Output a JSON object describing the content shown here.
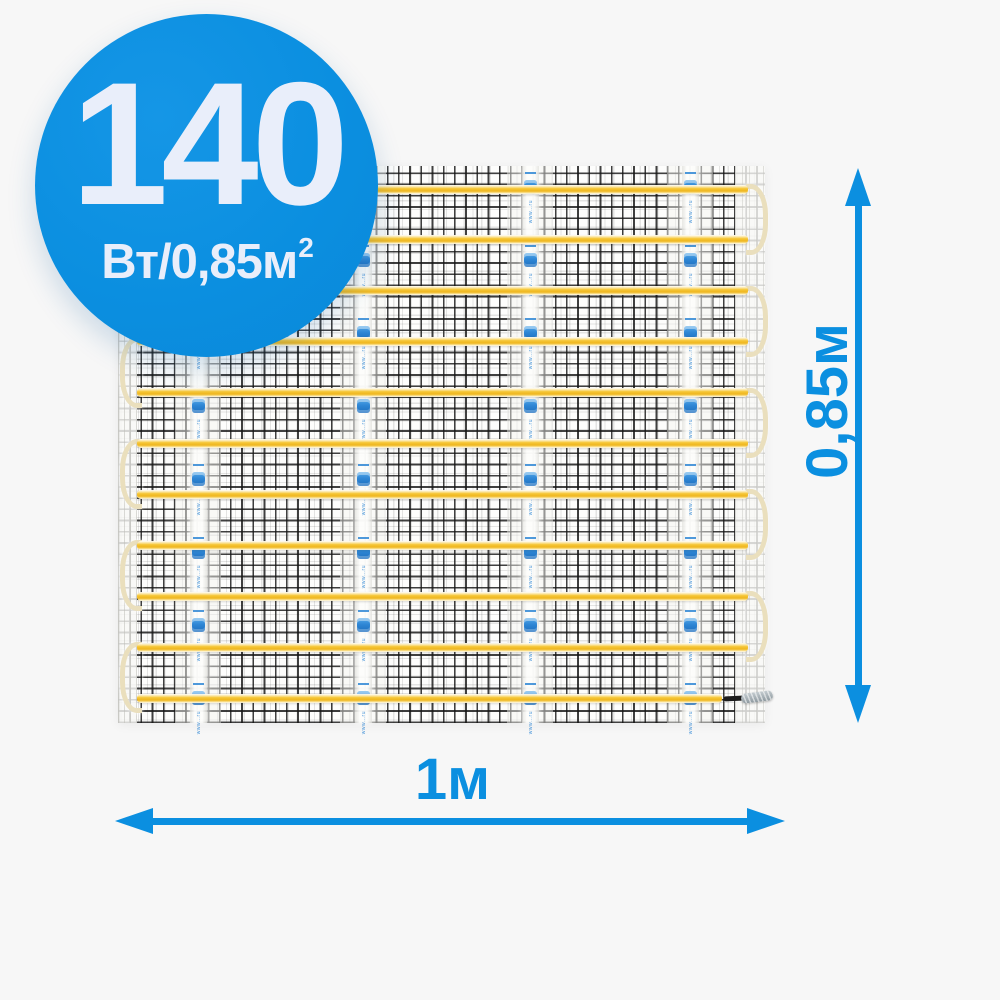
{
  "badge": {
    "value": "140",
    "unit_main": "Вт/0,85м",
    "unit_sup": "2"
  },
  "dimensions": {
    "height": "0,85м",
    "width": "1м"
  },
  "tape": {
    "url_text": "www…ru"
  },
  "colors": {
    "accent_blue": "#0b8fe0",
    "badge_text": "#e9eefa",
    "cable_yellow": "#f5c636",
    "cable_turn": "#eadfbd",
    "tape_mark_blue": "#2f87d5",
    "mesh_black": "#1a1a1a",
    "mat_white": "#fdfdfc",
    "background": "#f7f7f7"
  },
  "mat_layout": {
    "line_count": 11,
    "first_line_y": 23,
    "line_spacing": 50.9,
    "line_x_start": 19,
    "line_x_end": 630,
    "connector_line_x_end": 604,
    "tape_centers": [
      80,
      245,
      412,
      572
    ],
    "tape_width": 17,
    "tape_mark_period": 73,
    "left_turn_pairs": [
      [
        1,
        2
      ],
      [
        3,
        4
      ],
      [
        5,
        6
      ],
      [
        7,
        8
      ],
      [
        9,
        10
      ]
    ],
    "right_turn_pairs": [
      [
        0,
        1
      ],
      [
        2,
        3
      ],
      [
        4,
        5
      ],
      [
        6,
        7
      ],
      [
        8,
        9
      ]
    ]
  }
}
